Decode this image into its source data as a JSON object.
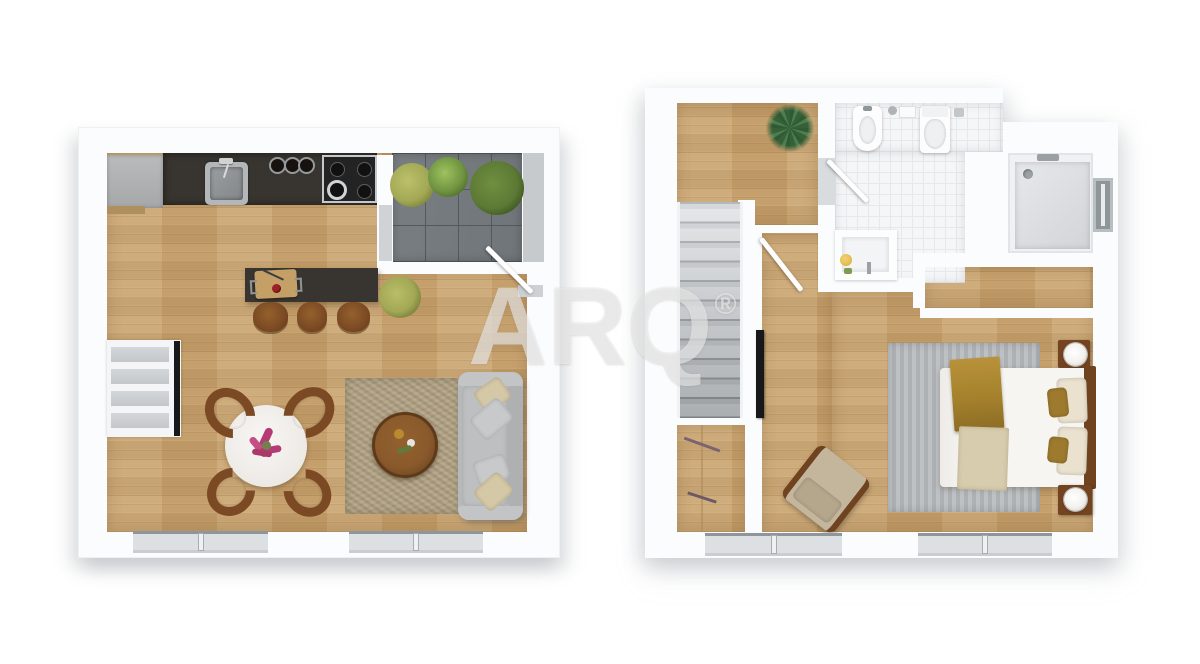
{
  "title": "3d-floor-plan-two-levels",
  "watermark": {
    "brand": "ARQ",
    "registered": "®"
  },
  "palette": {
    "pageBg": "#ffffff",
    "slab": "#fbfcfd",
    "wood": "#c9a26c",
    "counter": "#38342f",
    "terraceTile": "#6f7579",
    "terraceGrid": "#54595d",
    "parapet": "#c6cacd",
    "tile": "#f5f6f8",
    "tileGrid": "#e6e8ea",
    "stairLight": "#dcdfe1",
    "stairDark": "#979da1",
    "rugBeige": "#b2a386",
    "rugGray": "#b7babd",
    "sofaGray": "#b7b8ba",
    "pillowBeige": "#d5c8a6",
    "pillowGray": "#c7c9cb",
    "brown": "#7b4a24",
    "brownDark": "#6f4320",
    "bedWhite": "#f6f5f1",
    "gold": "#a5812d",
    "throwBeige": "#d8ccae",
    "plantOlive": "#a2a855",
    "plantGreen": "#6f9340",
    "plantDark": "#2f5a33",
    "flowerPink": "#b43b74",
    "tomato": "#9c2026",
    "lampWhite": "#f2f1ed",
    "glass": "#dde0e2",
    "frameGray": "#8f969a",
    "sill": "#c9cdd0",
    "cabinetGray": "#b0b2b4",
    "tvBlack": "#17181a",
    "wmColor": "rgba(255,255,255,0.52)",
    "shadow": "rgba(150,156,162,0.30)"
  },
  "floors": [
    {
      "id": "first-floor",
      "rooms": [
        "kitchen",
        "dining-living-room",
        "terrace"
      ],
      "objects": [
        "fridge-cabinet",
        "kitchen-counter",
        "sink",
        "hob-jars",
        "gas-stove",
        "kitchen-island",
        "cutting-board",
        "bar-stools",
        "terrace-plants",
        "indoor-plant",
        "shelf-unit-with-tv",
        "dining-table-with-flowers",
        "dining-chairs",
        "area-rug",
        "coffee-table",
        "sofa-with-pillows",
        "entry-door",
        "windows"
      ]
    },
    {
      "id": "second-floor",
      "rooms": [
        "hallway",
        "staircase",
        "bathroom",
        "shower-room",
        "closet",
        "bedroom"
      ],
      "objects": [
        "palm-plant",
        "bidet",
        "toilet",
        "wall-basin",
        "vanity-unit",
        "shower-tray",
        "side-window",
        "staircase",
        "closet-boards",
        "tv-panel",
        "bathroom-door",
        "bedroom-door",
        "wardrobe-niche",
        "bedroom-rug",
        "double-bed",
        "gold-blanket",
        "beige-throw",
        "pillows",
        "nightstands",
        "table-lamps",
        "armchair",
        "windows"
      ]
    }
  ]
}
